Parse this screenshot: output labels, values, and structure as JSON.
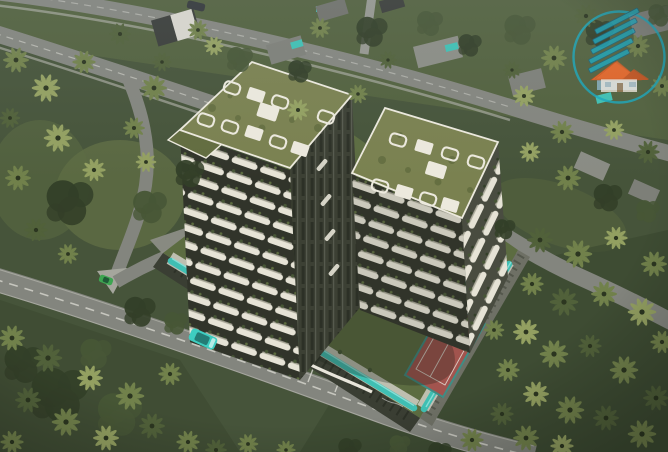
{
  "meta": {
    "title": "aerial-3d-render-twin-residential-towers",
    "image_type": "architectural-visualization",
    "view": "aerial-oblique",
    "time_of_day": "dusk"
  },
  "palette": {
    "bg": "#46543a",
    "bg_dark": "#39452e",
    "lawn": "#5c6c41",
    "lawn_light": "#6d7c4a",
    "tree_dark": "#333f28",
    "tree_mid": "#475636",
    "tree_light": "#5d6d40",
    "palm_light": "#93a061",
    "palm_mid": "#71814b",
    "palm_dark": "#51613a",
    "palm_deep": "#3e4c2f",
    "road": "#83857e",
    "road_light": "#95978f",
    "sidewalk": "#a5a69d",
    "road_line": "#dcdcd4",
    "tower_dark": "#23261e",
    "tower_mid": "#31342a",
    "tower_glass": "#3c4034",
    "facade_line": "#565a4e",
    "balcony_white": "#e6e3d6",
    "balcony_cream": "#cfccbc",
    "roof_green": "#7a8150",
    "roof_green_dark": "#626c3f",
    "parapet": "#ece9dd",
    "pool": "#3fbfb3",
    "pool_light": "#8fe0d8",
    "deck": "#c9c9bd",
    "court_red": "#a2544e",
    "court_blue": "#4fa39a",
    "court_line": "#e8e8e0",
    "court_border": "#3f8d84",
    "car_teal": "#3ecdc0",
    "car_green": "#3da551",
    "car_dark": "#34383a",
    "car_glass": "#17504d",
    "podium_wall": "#3a3e33",
    "podium_wall_light": "#6e7065",
    "ribbon": "#e8e5da",
    "villa_dark": "#3a3d39",
    "villa_gray": "#7d7f78",
    "villa_light": "#8a8c84",
    "wm_teal": "#18a7bd",
    "wm_navy": "#16637f",
    "wm_orange": "#e0662a",
    "wm_orange_dark": "#c05522",
    "wm_wall": "#f2ece2"
  },
  "scene": {
    "labels": {
      "scene": "aerial-view-of-twin-residential-towers-in-palm-landscape",
      "vegetation": "palm-groves-and-trees",
      "roads": "surrounding-roads",
      "villas": "neighborhood-villas",
      "podium": "landscaped-podium-deck",
      "pool": "perimeter-lap-pool",
      "tennis_court": "red-tennis-court",
      "sport_court": "blue-sports-court",
      "maze": "hedge-maze-garden",
      "towers": "twin-residential-towers",
      "rooftops": "rooftop-gardens-with-white-pergolas",
      "parking": "street-parking-bays",
      "van": "teal-minivan",
      "car": "green-car",
      "dark_car": "dark-car",
      "watermark": "house-logo-watermark"
    }
  },
  "watermark": {
    "motif": "house-with-roof-swooshes-in-circle",
    "swoosh_color": "#18a7bd",
    "roof_color": "#e0662a",
    "wall_color": "#f2ece2"
  }
}
